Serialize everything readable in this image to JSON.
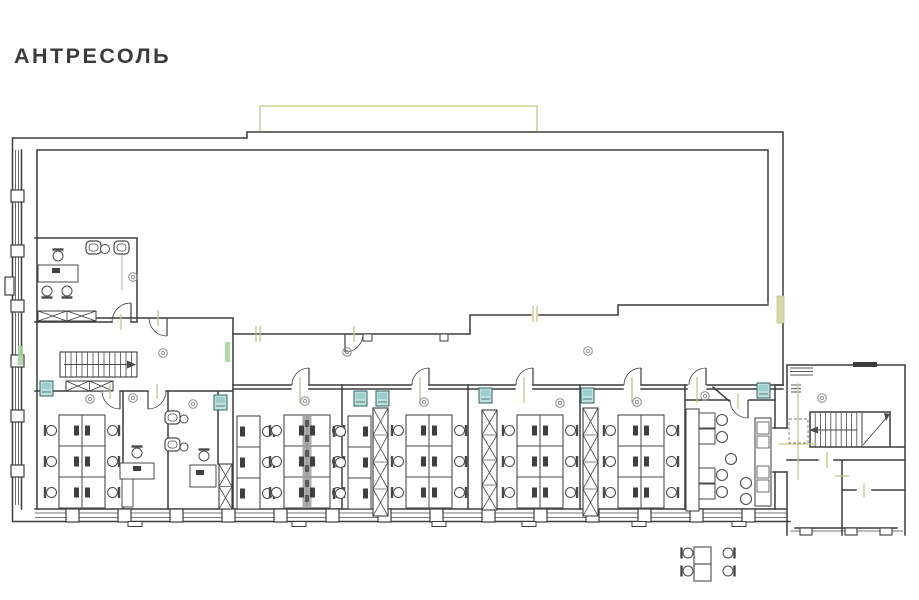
{
  "title": "АНТРЕСОЛЬ",
  "palette": {
    "wall": "#3c3c3c",
    "furniture": "#4a4a4a",
    "symbol": "#8a8a8a",
    "olive": "#c3c489",
    "olive_fill": "#d8d9a8",
    "teal_fill": "#bfe0dd",
    "teal_inner": "#9ccfcb",
    "teal_stroke": "#2f6165",
    "green": "#a5d6a0",
    "divider_gray": "#9c9c9c",
    "monitor": "#3f3f3f"
  },
  "plan": {
    "cluster_size": {
      "col_w": 23,
      "h": 93,
      "rows": 3
    },
    "clusters": [
      {
        "x": 59,
        "y": 415,
        "cols": 2,
        "chairs": "both"
      },
      {
        "x": 237,
        "y": 416,
        "cols": 1,
        "chairs": "right"
      },
      {
        "x": 284,
        "y": 415,
        "cols": 2,
        "chairs": "both",
        "divider": true
      },
      {
        "x": 348,
        "y": 416,
        "cols": 1,
        "chairs": "left"
      },
      {
        "x": 406,
        "y": 415,
        "cols": 2,
        "chairs": "both"
      },
      {
        "x": 517,
        "y": 415,
        "cols": 2,
        "chairs": "both"
      },
      {
        "x": 618,
        "y": 415,
        "cols": 2,
        "chairs": "both"
      }
    ],
    "piers": [
      [
        219,
        464,
        13,
        45,
        2
      ],
      [
        373,
        408,
        15,
        108,
        4
      ],
      [
        482,
        410,
        15,
        100,
        4
      ],
      [
        583,
        408,
        15,
        108,
        4
      ]
    ],
    "hatches": [
      [
        38,
        311,
        58,
        10
      ],
      [
        66,
        381,
        47,
        10
      ]
    ],
    "teal_units": [
      [
        40,
        381
      ],
      [
        214,
        395
      ],
      [
        354,
        391
      ],
      [
        376,
        391
      ],
      [
        479,
        388
      ],
      [
        581,
        388
      ],
      [
        757,
        383
      ]
    ],
    "green_marks": [
      [
        18,
        346,
        5,
        19
      ],
      [
        225,
        342,
        5,
        20
      ]
    ],
    "olive_rects": [
      [
        777,
        296,
        7,
        27
      ]
    ],
    "olive_ticks": [
      [
        256,
        326,
        256,
        342
      ],
      [
        260,
        326,
        260,
        342
      ],
      [
        533,
        306,
        533,
        322
      ],
      [
        537,
        306,
        537,
        322
      ],
      [
        300,
        377,
        300,
        403
      ],
      [
        420,
        377,
        420,
        403
      ],
      [
        524,
        377,
        524,
        403
      ],
      [
        632,
        377,
        632,
        403
      ],
      [
        697,
        377,
        697,
        403
      ],
      [
        110,
        384,
        110,
        399
      ],
      [
        157,
        384,
        157,
        399
      ],
      [
        738,
        393,
        738,
        409
      ],
      [
        798,
        383,
        798,
        480
      ],
      [
        779,
        444,
        817,
        444
      ],
      [
        827,
        452,
        827,
        468
      ],
      [
        835,
        476,
        849,
        476
      ],
      [
        864,
        483,
        864,
        497
      ],
      [
        121,
        314,
        121,
        330
      ],
      [
        158,
        310,
        158,
        326
      ],
      [
        354,
        326,
        354,
        342
      ]
    ],
    "circle_symbols": [
      [
        133,
        277
      ],
      [
        163,
        353
      ],
      [
        133,
        398
      ],
      [
        90,
        399
      ],
      [
        193,
        404
      ],
      [
        305,
        401
      ],
      [
        347,
        352
      ],
      [
        424,
        402
      ],
      [
        560,
        403
      ],
      [
        588,
        351
      ],
      [
        637,
        402
      ],
      [
        705,
        396
      ],
      [
        822,
        398
      ]
    ],
    "doors": [
      [
        131,
        322,
        -90,
        180,
        19
      ],
      [
        120,
        391,
        90,
        180,
        18
      ],
      [
        148,
        391,
        90,
        0,
        18
      ],
      [
        167,
        318,
        90,
        180,
        18
      ],
      [
        345,
        334,
        90,
        0,
        18
      ],
      [
        309,
        385,
        -90,
        180,
        17
      ],
      [
        429,
        385,
        -90,
        180,
        17
      ],
      [
        533,
        385,
        -90,
        180,
        17
      ],
      [
        641,
        385,
        -90,
        180,
        17
      ],
      [
        706,
        385,
        -90,
        180,
        17
      ],
      [
        748,
        400,
        90,
        180,
        18
      ]
    ],
    "desks": [
      [
        38,
        265,
        40,
        17
      ],
      [
        120,
        463,
        34,
        16
      ],
      [
        122,
        479,
        11,
        28
      ],
      [
        190,
        465,
        26,
        22
      ]
    ],
    "desk_monitors": [
      [
        52,
        268
      ],
      [
        133,
        466
      ],
      [
        196,
        470
      ]
    ],
    "chairs": [
      [
        58,
        256,
        "down"
      ],
      [
        47,
        291,
        "up"
      ],
      [
        67,
        291,
        "up"
      ],
      [
        137,
        453,
        "down"
      ],
      [
        204,
        456,
        "down"
      ],
      [
        688,
        553,
        "right"
      ],
      [
        688,
        571,
        "right"
      ],
      [
        728,
        553,
        "left"
      ],
      [
        728,
        571,
        "left"
      ]
    ],
    "armchairs": [
      [
        86,
        241
      ],
      [
        114,
        241
      ],
      [
        165,
        411
      ],
      [
        165,
        438
      ]
    ],
    "round_tables": [
      [
        105,
        249,
        4.5
      ],
      [
        184,
        419,
        4
      ],
      [
        184,
        447,
        4
      ]
    ],
    "kitchen": {
      "counters": [
        [
          686,
          409,
          13,
          102
        ],
        [
          755,
          418,
          16,
          88
        ]
      ],
      "tables": [
        [
          699,
          413,
          16,
          15
        ],
        [
          699,
          429,
          16,
          15
        ],
        [
          699,
          468,
          16,
          15
        ],
        [
          699,
          484,
          16,
          15
        ]
      ],
      "stools": [
        [
          722,
          420
        ],
        [
          722,
          437
        ],
        [
          731,
          459
        ],
        [
          722,
          475
        ],
        [
          722,
          492
        ],
        [
          746,
          483
        ],
        [
          746,
          499
        ]
      ],
      "appliances": [
        [
          757,
          422,
          12,
          12
        ],
        [
          757,
          436,
          12,
          12
        ],
        [
          757,
          466,
          12,
          12
        ],
        [
          757,
          480,
          12,
          12
        ]
      ]
    },
    "outside_table": [
      [
        694,
        547,
        17,
        17
      ],
      [
        694,
        564,
        17,
        17
      ]
    ],
    "stairs_left": {
      "x": 60,
      "y": 352,
      "w": 77,
      "h": 25,
      "treads": 13
    },
    "stairs_right": {
      "x": 810,
      "y": 413,
      "w": 52,
      "h": 34,
      "treads": 9
    },
    "sills": [
      [
        128,
        521.5,
        14,
        5
      ],
      [
        292,
        521.5,
        14,
        5
      ],
      [
        432,
        521.5,
        14,
        5
      ],
      [
        522,
        521.5,
        14,
        5
      ],
      [
        632,
        521.5,
        14,
        5
      ],
      [
        732,
        521.5,
        14,
        5
      ]
    ],
    "notches": [
      [
        363,
        334,
        9,
        7
      ],
      [
        440,
        334,
        8,
        7
      ]
    ],
    "windows_bottom": {
      "piers": [
        66,
        118,
        170,
        222,
        274,
        326,
        378,
        430,
        482,
        534,
        586,
        638,
        690,
        742
      ],
      "y": 509,
      "x1": 35,
      "x2": 787
    },
    "windows_left": {
      "piers": [
        190,
        245,
        300,
        355,
        410,
        465
      ],
      "x": 11,
      "y1": 150,
      "y2": 505
    },
    "windows_rwing": {
      "piers": [
        800,
        845,
        880
      ],
      "y": 528,
      "x1": 790,
      "x2": 903
    }
  }
}
